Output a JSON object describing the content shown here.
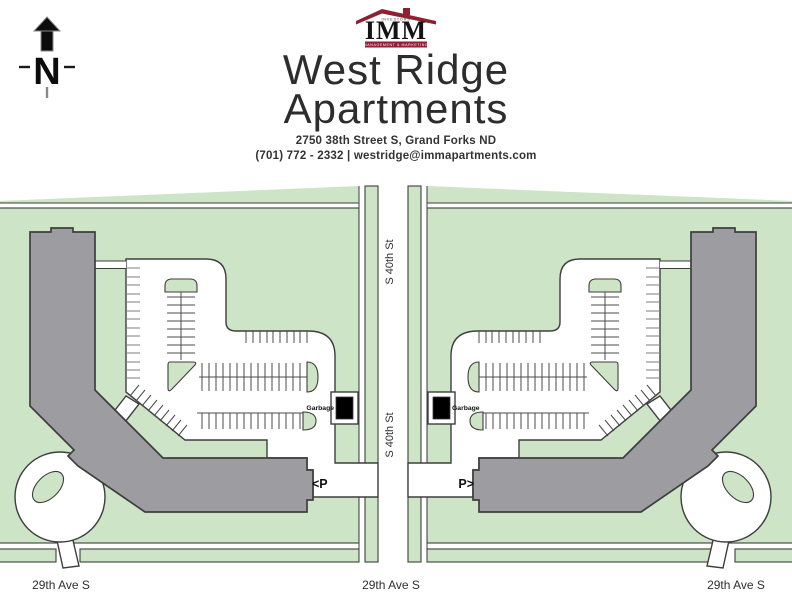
{
  "logo": {
    "publisher_small_text": "INVESTORS",
    "name": "IMM",
    "tagline": "MANAGEMENT & MARKETING"
  },
  "header": {
    "title_line1": "West Ridge",
    "title_line2": "Apartments",
    "address": "2750 38th Street S, Grand Forks ND",
    "phone_email": "(701) 772 - 2332 | westridge@immapartments.com"
  },
  "compass": {
    "north_label": "N"
  },
  "map": {
    "vertical_street_label": "S 40th St",
    "horizontal_street_label": "29th Ave S",
    "garbage_label": "Garbage",
    "parking_entrance_left": "<P",
    "parking_entrance_right": "P>"
  },
  "colors": {
    "green": "#cde4c6",
    "building-gray": "#9c9ca1",
    "line": "#3e3e3e",
    "maroon": "#8e2031",
    "title-text": "#2d2d2d"
  }
}
